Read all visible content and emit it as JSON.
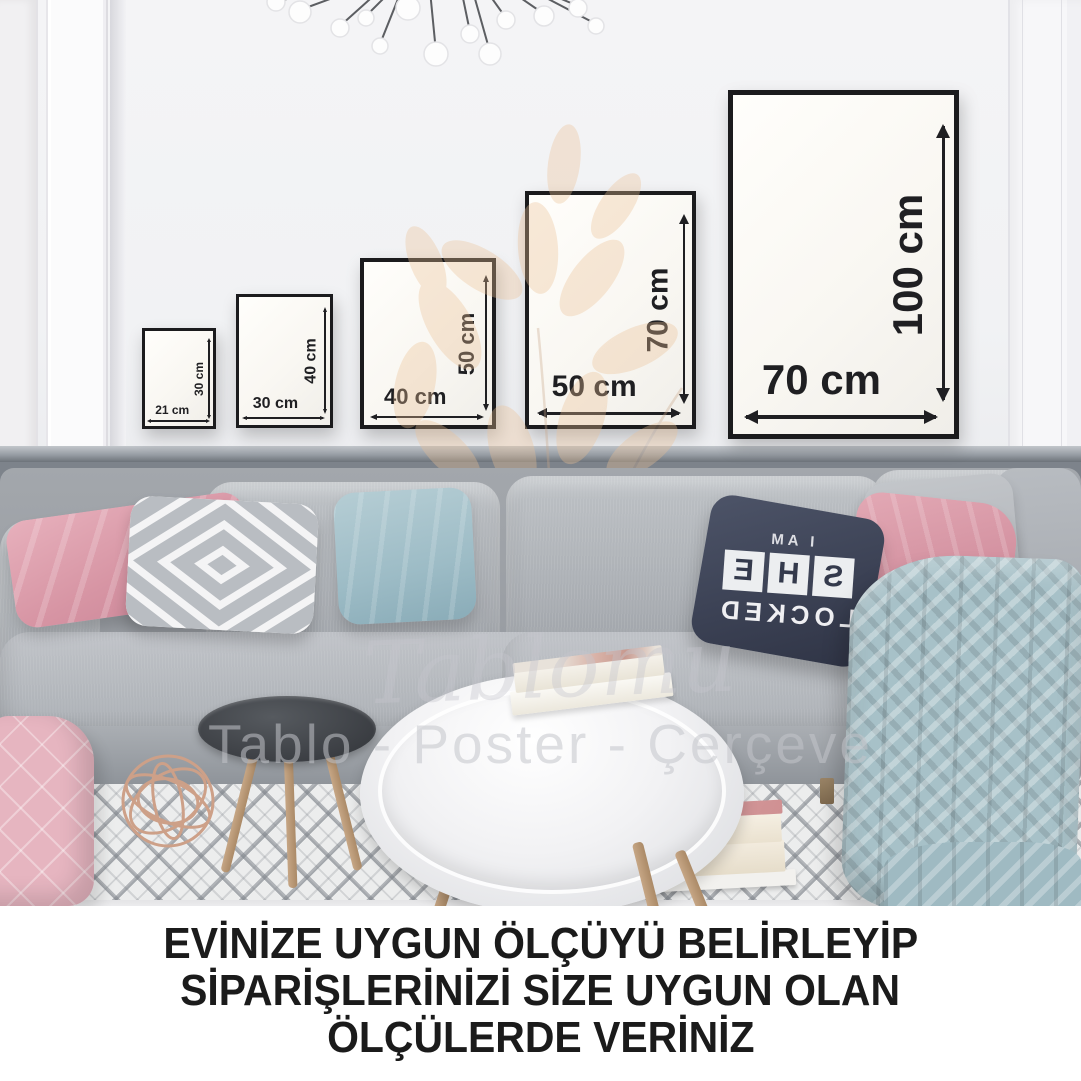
{
  "watermark": {
    "script": "Tablomu",
    "tagline": "Tablo - Poster - Çerçeve"
  },
  "frames": [
    {
      "w": "21 cm",
      "h": "30 cm"
    },
    {
      "w": "30 cm",
      "h": "40 cm"
    },
    {
      "w": "40 cm",
      "h": "50 cm"
    },
    {
      "w": "50 cm",
      "h": "70 cm"
    },
    {
      "w": "70 cm",
      "h": "100 cm"
    }
  ],
  "pillow": {
    "top": "I AM",
    "letters": [
      "S",
      "H",
      "E"
    ],
    "bottom": "LOCKED"
  },
  "caption": {
    "line1": "EVİNİZE UYGUN ÖLÇÜYÜ BELİRLEYİP",
    "line2": "SİPARİŞLERİNİZİ SİZE UYGUN OLAN",
    "line3": "ÖLÇÜLERDE VERİNİZ"
  },
  "colors": {
    "frame_border": "#1b1b1d",
    "wainscot_gray": "#7d838b",
    "pillow_pink": "#dfa3ae",
    "pillow_blue": "#a8c3cb",
    "pillow_navy": "#3c4255",
    "blanket_blue": "#a7c1c8",
    "watermark_flower": "#ecc195",
    "caption_text": "#1b1b1b"
  }
}
